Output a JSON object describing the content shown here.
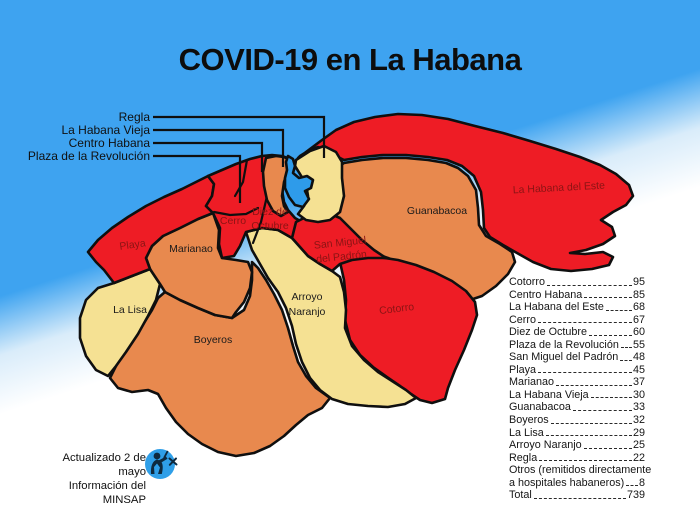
{
  "title": "COVID-19 en La Habana",
  "callouts": {
    "regla": "Regla",
    "habana_vieja": "La Habana Vieja",
    "centro_habana": "Centro Habana",
    "plaza": "Plaza de la Revolución"
  },
  "map_labels": {
    "playa": "Playa",
    "marianao": "Marianao",
    "la_lisa": "La Lisa",
    "boyeros": "Boyeros",
    "cerro": "Cerro",
    "diez_1": "Diez de",
    "diez_2": "Octubre",
    "arroyo_1": "Arroyo",
    "arroyo_2": "Naranjo",
    "smp_1": "San Miguel",
    "smp_2": "del Padrón",
    "cotorro": "Cotorro",
    "guanabacoa": "Guanabacoa",
    "este": "La Habana del Este"
  },
  "stats": {
    "rows": [
      {
        "label": "Cotorro",
        "value": "95"
      },
      {
        "label": "Centro Habana",
        "value": "85"
      },
      {
        "label": "La Habana del Este",
        "value": "68"
      },
      {
        "label": "Cerro",
        "value": "67"
      },
      {
        "label": "Diez de Octubre",
        "value": "60"
      },
      {
        "label": "Plaza de la Revolución",
        "value": "55"
      },
      {
        "label": "San Miguel del Padrón",
        "value": "48"
      },
      {
        "label": "Playa",
        "value": "45"
      },
      {
        "label": "Marianao",
        "value": "37"
      },
      {
        "label": "La Habana Vieja",
        "value": "30"
      },
      {
        "label": "Guanabacoa",
        "value": "33"
      },
      {
        "label": "Boyeros",
        "value": "32"
      },
      {
        "label": "La Lisa",
        "value": "29"
      },
      {
        "label": "Arroyo Naranjo",
        "value": "25"
      },
      {
        "label": "Regla",
        "value": "22"
      },
      {
        "label": "Otros (remitidos directamente",
        "value": ""
      },
      {
        "label": "a hospitales habaneros)",
        "value": "8"
      },
      {
        "label": "Total",
        "value": "739"
      }
    ]
  },
  "footer": {
    "updated": "Actualizado 2 de mayo",
    "source": "Información del MINSAP"
  },
  "colors": {
    "high_cases_red": "#ee1c25",
    "medium_cases_orange": "#e8894e",
    "low_cases_yellow": "#f5e193",
    "sea_blue": "#3ea3f0",
    "bay_blue": "#2e9bea",
    "dark_red_label": "#8b1414"
  }
}
